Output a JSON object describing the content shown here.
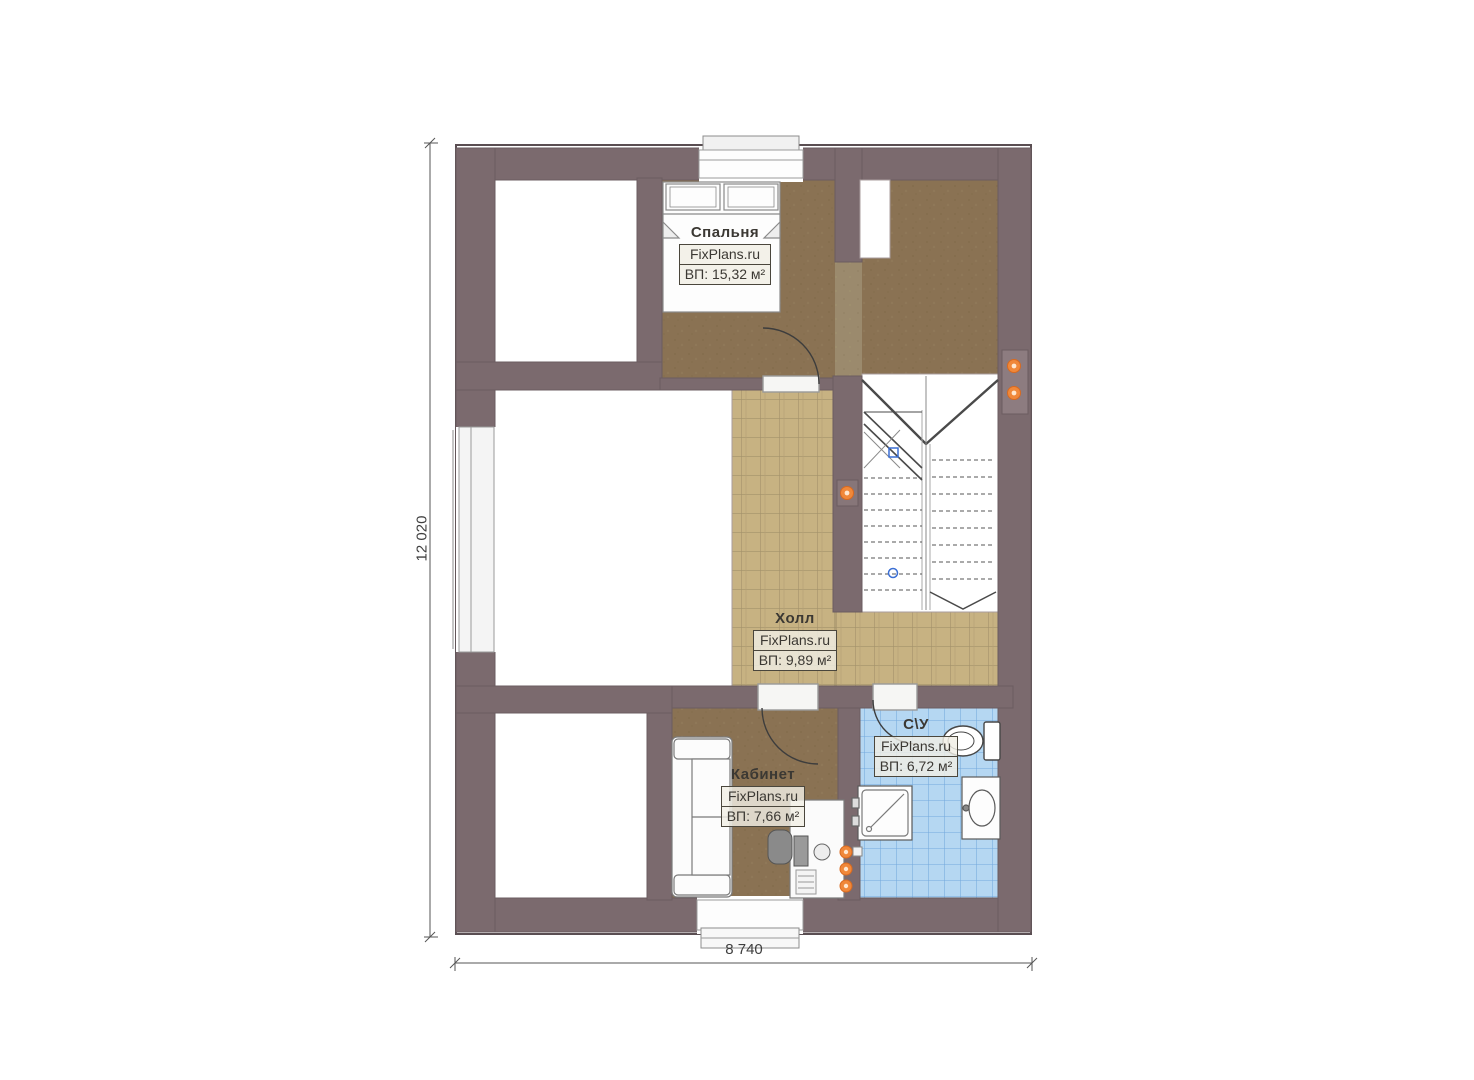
{
  "plan": {
    "type": "floor-plan",
    "rooms": {
      "bedroom": {
        "name": "Спальня",
        "site": "FixPlans.ru",
        "area": "ВП: 15,32 м²"
      },
      "hall": {
        "name": "Холл",
        "site": "FixPlans.ru",
        "area": "ВП: 9,89 м²"
      },
      "office": {
        "name": "Кабинет",
        "site": "FixPlans.ru",
        "area": "ВП: 7,66 м²"
      },
      "bathroom": {
        "name": "С\\У",
        "site": "FixPlans.ru",
        "area": "ВП: 6,72 м²"
      }
    },
    "dimensions": {
      "left": "12 020",
      "bottom": "8 740"
    },
    "colors": {
      "wall": "#7b6a6e",
      "floor_wood": "#8a7253",
      "floor_passage": "#9b8a6d",
      "floor_tile": "#c7b282",
      "floor_bath": "#b5d7f2",
      "marker": "#f0883a",
      "stair_line": "#4a4a4a"
    }
  }
}
